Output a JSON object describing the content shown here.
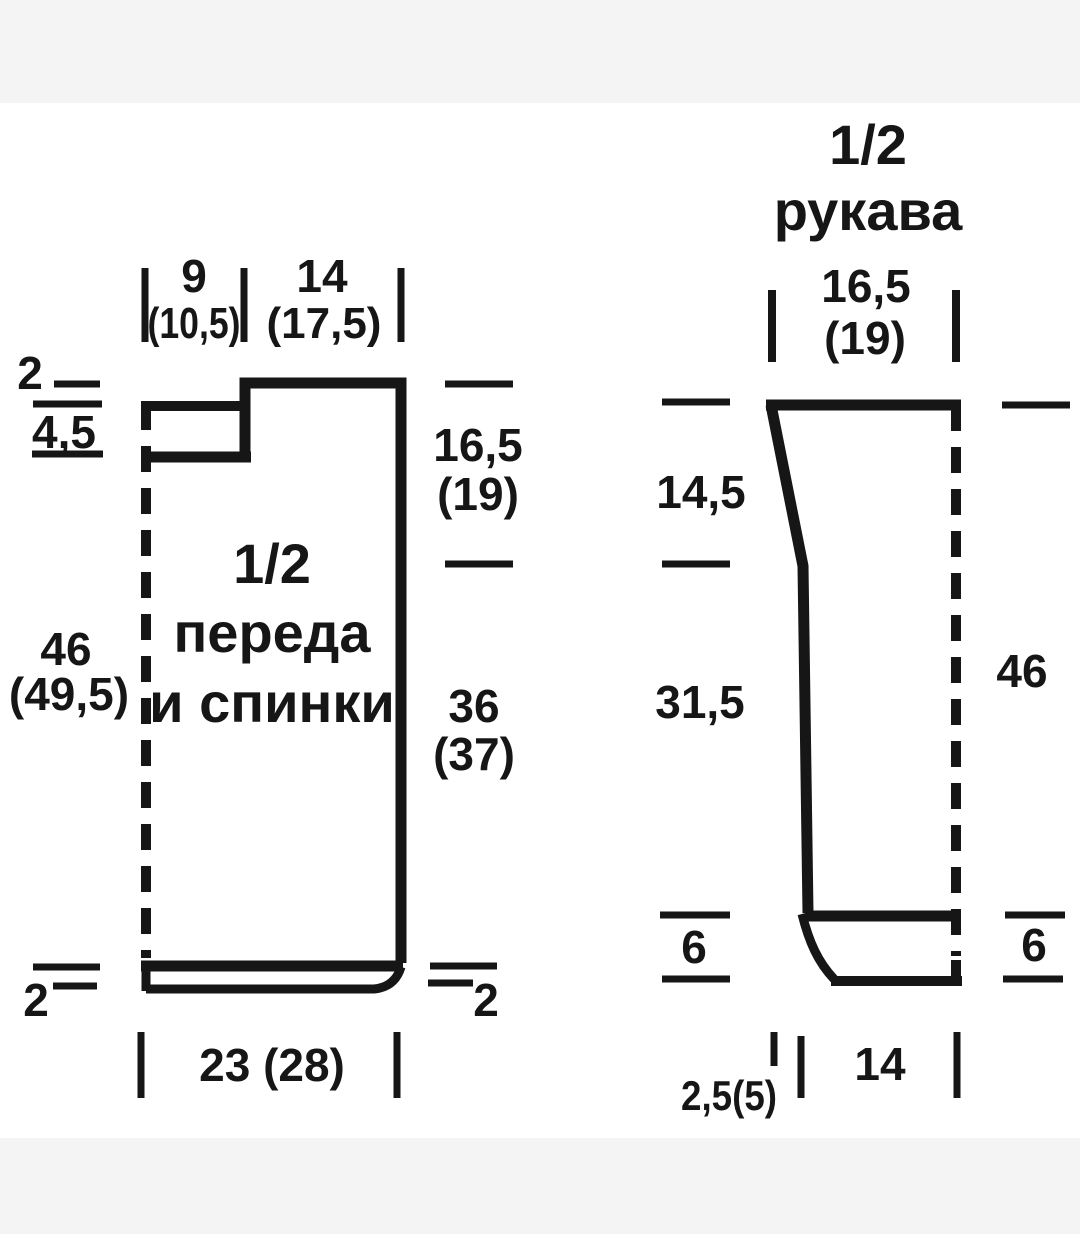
{
  "colors": {
    "background": "#f4f4f5",
    "paper": "#ffffff",
    "ink": "#161616"
  },
  "front_back": {
    "title": [
      "1/2",
      "переда",
      "и спинки"
    ],
    "top": {
      "shoulder": "9",
      "shoulder_alt": "(10,5)",
      "neck": "14",
      "neck_alt": "(17,5)"
    },
    "left": {
      "neck_drop": "2",
      "neckband": "4,5",
      "length": "46",
      "length_alt": "(49,5)",
      "hem": "2"
    },
    "right": {
      "armhole": "16,5",
      "armhole_alt": "(19)",
      "side": "36",
      "side_alt": "(37)",
      "hem": "2"
    },
    "bottom": {
      "width": "23 (28)"
    }
  },
  "sleeve": {
    "title": [
      "1/2",
      "рукава"
    ],
    "top": {
      "width": "16,5",
      "width_alt": "(19)"
    },
    "left": {
      "cap": "14,5",
      "seam": "31,5",
      "cuff": "6"
    },
    "right": {
      "length": "46",
      "cuff": "6"
    },
    "bottom": {
      "vent": "2,5(5)",
      "width": "14"
    }
  }
}
